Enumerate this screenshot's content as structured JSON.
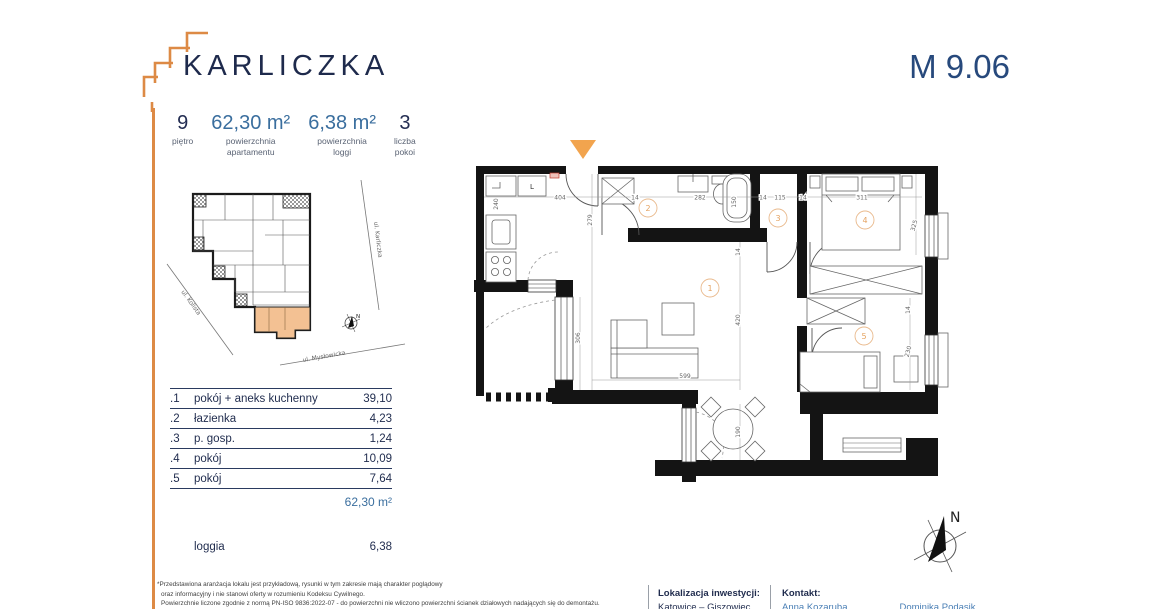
{
  "header": {
    "brand": "KARLICZKA",
    "unit": "M 9.06"
  },
  "stats": [
    {
      "value": "9",
      "label1": "piętro",
      "label2": ""
    },
    {
      "value": "62,30 m²",
      "label1": "powierzchnia",
      "label2": "apartamentu"
    },
    {
      "value": "6,38 m²",
      "label1": "powierzchnia",
      "label2": "loggi"
    },
    {
      "value": "3",
      "label1": "liczba",
      "label2": "pokoi"
    }
  ],
  "rooms": [
    {
      "no": ".1",
      "name": "pokój + aneks kuchenny",
      "area": "39,10"
    },
    {
      "no": ".2",
      "name": "łazienka",
      "area": "4,23"
    },
    {
      "no": ".3",
      "name": "p. gosp.",
      "area": "1,24"
    },
    {
      "no": ".4",
      "name": "pokój",
      "area": "10,09"
    },
    {
      "no": ".5",
      "name": "pokój",
      "area": "7,64"
    }
  ],
  "table": {
    "total": "62,30 m²",
    "loggia_label": "loggia",
    "loggia_area": "6,38"
  },
  "compass": "N",
  "site_map": {
    "streets": {
      "right": "ul. Karliczka",
      "left": "ul. Kolista",
      "bottom": "ul. Mysłowicka"
    }
  },
  "floorplan": {
    "fridge": "L",
    "room_numbers": {
      "r1": "1",
      "r2": "2",
      "r3": "3",
      "r4": "4",
      "r5": "5"
    },
    "dims": {
      "kitchen_top": "404",
      "entry_side": "279",
      "kitchen_left": "240",
      "gap1": "14",
      "bath_w": "282",
      "tub_h": "150",
      "gap2": "14",
      "storage_w": "115",
      "gap3": "14",
      "bed4_w": "311",
      "bed4_h": "325",
      "corridor": "14",
      "living_h": "420",
      "living_left": "306",
      "living_w": "599",
      "loggia_t": "190",
      "room5_h": "230",
      "room5_gap": "14"
    }
  },
  "footer": {
    "disclaimer": [
      "*Przedstawiona aranżacja lokalu jest przykładową, rysunki w tym zakresie mają charakter poglądowy",
      "oraz informacyjny i nie stanowi oferty w rozumieniu Kodeksu Cywilnego.",
      "Powierzchnie liczone zgodnie z normą PN-ISO 9836:2022-07 - do powierzchni nie wliczono powierzchni ścianek działowych nadających się do demontażu."
    ],
    "location_label": "Lokalizacja inwestycji:",
    "location_value": "Katowice – Giszowiec",
    "contact_label": "Kontakt:",
    "contact1": "Anna Kozaruba",
    "contact2": "Dominika Podasik"
  },
  "colors": {
    "accent_orange": "#DD8A45",
    "navy": "#1F2B4D",
    "steel_blue": "#3A6E9E",
    "contact_blue": "#4A7FB5"
  }
}
